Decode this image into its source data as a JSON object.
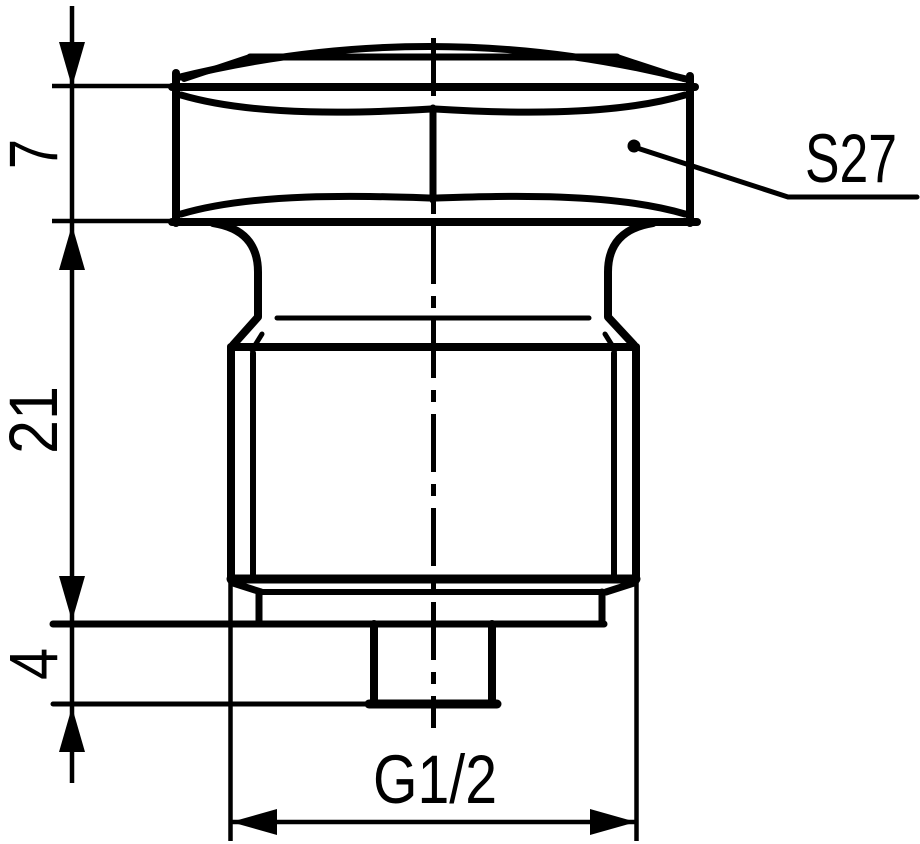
{
  "drawing": {
    "kind": "technical-dimension-drawing",
    "subject": "hex-head threaded plug, side view",
    "colors": {
      "line": "#000000",
      "background": "#ffffff"
    },
    "labels": {
      "head_height": "7",
      "body_length": "21",
      "tip_length": "4",
      "wrench_size": "S27",
      "thread_size": "G1/2"
    }
  }
}
